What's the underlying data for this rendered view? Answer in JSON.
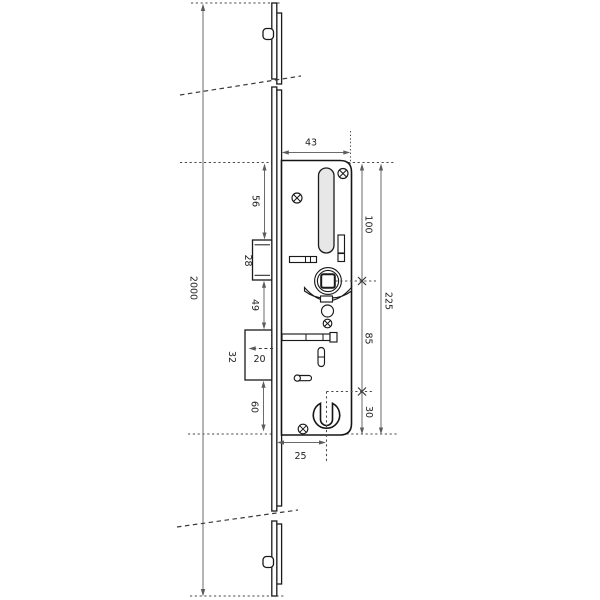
{
  "dimensions": {
    "faceplate_length": "2000",
    "case_width": "43",
    "top_to_latch": "56",
    "latch_height": "28",
    "latch_to_deadbolt": "49",
    "deadbolt_height": "32",
    "deadbolt_throw": "20",
    "deadbolt_to_case_bottom": "60",
    "cylinder_backset": "25",
    "top_to_follower": "100",
    "case_height": "225",
    "follower_to_cylinder": "85",
    "cylinder_to_bottom": "30"
  },
  "colors": {
    "background": "#ffffff",
    "part_outline": "#1a1a1a",
    "dimension_line": "#6b6b6b",
    "slot_fill": "#e7e7e7",
    "label_text": "#222222"
  }
}
